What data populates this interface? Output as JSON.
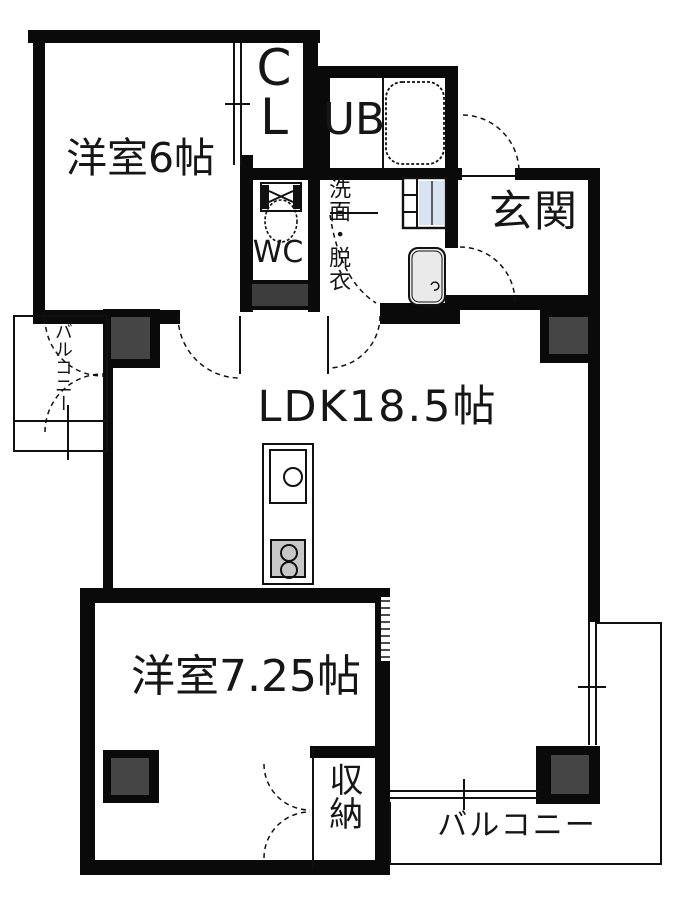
{
  "plan_title": "apartment-floor-plan",
  "rooms": {
    "western_room_6": {
      "label": "洋室6帖"
    },
    "closet": {
      "letters": [
        "C",
        "L"
      ]
    },
    "unit_bath": {
      "label": "UB"
    },
    "toilet_room": {
      "label": "WC"
    },
    "washroom": {
      "label": "洗面・脱衣"
    },
    "entrance": {
      "label": "玄関"
    },
    "ldk": {
      "label": "LDK18.5帖"
    },
    "western_room_7_25": {
      "label": "洋室7.25帖"
    },
    "storage": {
      "label": "収納"
    },
    "balcony_bottom": {
      "label": "バルコニー"
    },
    "balcony_left": {
      "label": "バルコニー"
    }
  },
  "fixtures": [
    "bathtub",
    "toilet",
    "washing-machine",
    "washbasin",
    "kitchen-sink",
    "stove"
  ],
  "colors": {
    "wall": "#0a0a0a",
    "pillar_fill": "#454545",
    "washer_fill": "#d9e4f3",
    "basin_fill": "#eaeaea",
    "stove_fill": "#c7c7c7",
    "background": "#ffffff",
    "line": "#111111"
  }
}
